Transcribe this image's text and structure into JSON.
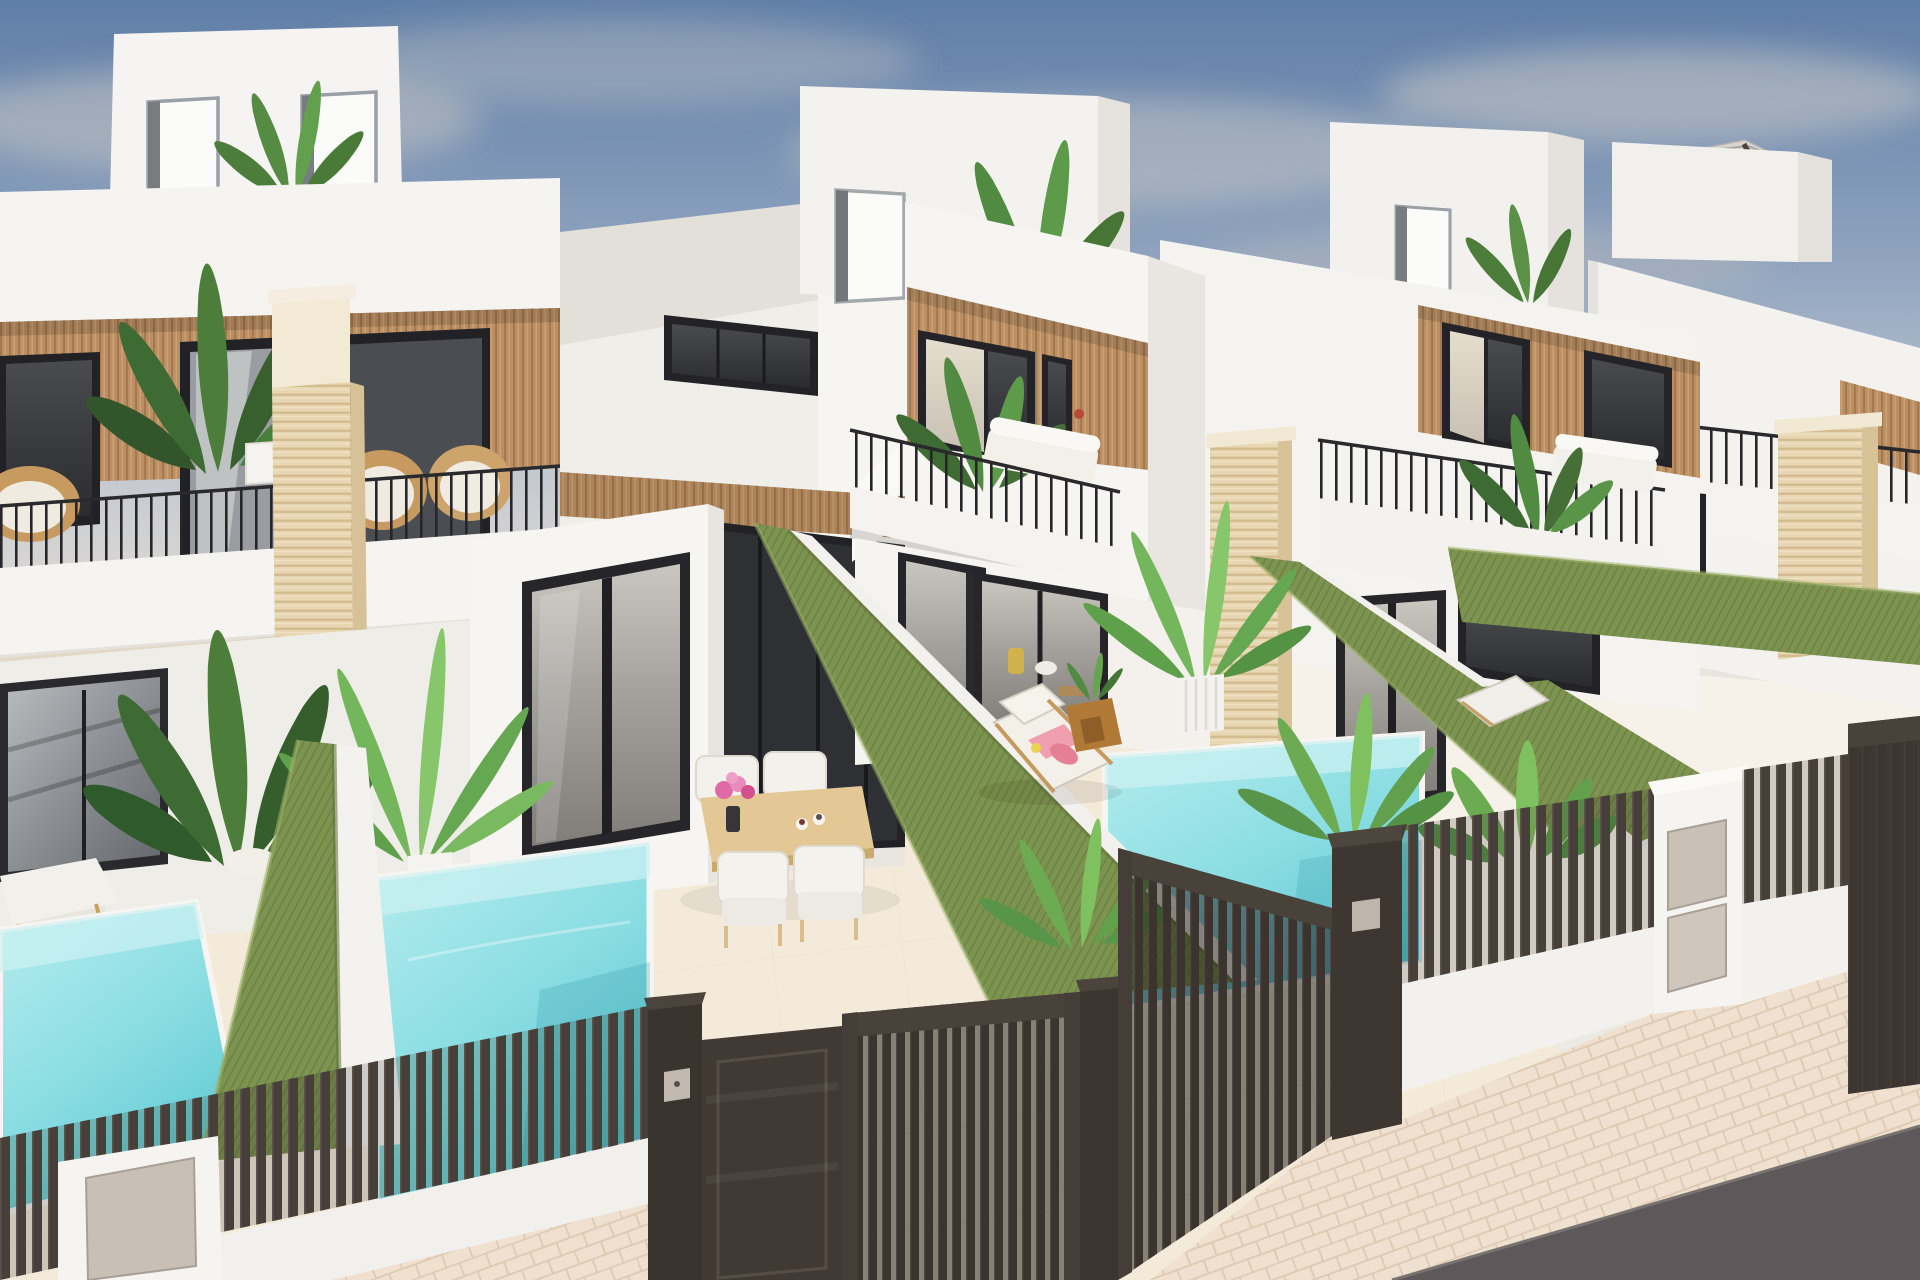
{
  "meta": {
    "scene_type": "exterior-architectural-render",
    "subject": "row of modern white townhouses with private plunge pools, roof terraces and street fence",
    "camera": "elevated three-quarter aerial view",
    "time_of_day": "clear daylight",
    "visible_text": ""
  },
  "palette": {
    "sky_top": "#5f7ea8",
    "sky_mid": "#93a7c2",
    "sky_horizon": "#ece9e3",
    "cloud": "#d8d1c8",
    "wall_white": "#f6f4f1",
    "wall_shadow": "#e7e4df",
    "wall_deep_shadow": "#d9d5d0",
    "wood_slat": "#bb8f63",
    "wood_slat_line": "#a3794d",
    "window_frame": "#232327",
    "glass_dark": "#36383c",
    "glass_reflective": "#9da1a5",
    "curtain": "#ded6c8",
    "railing_metal": "#26262a",
    "travertine": "#e8d7b2",
    "travertine_line": "#d2bc90",
    "grass_wall": "#7d9350",
    "grass_wall_shade": "#5f7338",
    "pool_light": "#b7edef",
    "pool_deep": "#5fc9d3",
    "patio_floor": "#f3ead9",
    "patio_floor_light": "#f7f2e9",
    "fence_dark": "#473f39",
    "gate_dark": "#413a34",
    "pavement": "#efe0cf",
    "pavement_joint": "#ddc9b1",
    "road_asphalt": "#5e585a",
    "rattan": "#c79a5f",
    "cushion_white": "#f2f0ea",
    "towel_pink": "#ef9fb0",
    "towel_pink_deep": "#e57f96",
    "table_wood": "#e3c795",
    "side_table_wood": "#b07a36",
    "plant_dark": "#3e6b33",
    "plant_mid": "#518a41",
    "plant_light": "#6fae54",
    "flower_pink": "#e06aa8",
    "metal_panel": "#c8bfb5",
    "parasol_canopy": "#d8d5d1"
  },
  "scene": {
    "sky": {
      "clouds": 6
    },
    "villas": [
      {
        "id": "villa-1",
        "features": [
          "roof-bulkhead-two-doors",
          "wood-slat-band",
          "two-dark-windows",
          "balcony-two-rattan-chairs",
          "travertine-pillar",
          "ground-glass-door",
          "plunge-pool",
          "dining-set"
        ]
      },
      {
        "id": "villa-2",
        "features": [
          "roof-bulkhead-door",
          "banana-plant",
          "wood-slat-band",
          "curtain-window",
          "balcony-sofa",
          "corner-glass-lounge",
          "sun-lounger",
          "potted-palm",
          "plunge-pool"
        ]
      },
      {
        "id": "villa-3",
        "features": [
          "roof-bulkhead-door",
          "wood-slat-band",
          "balcony-sofa",
          "travertine-pillar",
          "ground-glass-door"
        ]
      },
      {
        "id": "villa-4",
        "features": [
          "roof-parasol",
          "balcony-railing",
          "travertine-pillar",
          "sun-lounger"
        ]
      }
    ],
    "pools": [
      {
        "id": "pool-neighbor",
        "water": "turquoise"
      },
      {
        "id": "pool-villa-1",
        "water": "turquoise"
      },
      {
        "id": "pool-villa-2",
        "water": "turquoise"
      }
    ],
    "dividers": [
      {
        "id": "grass-wall-0"
      },
      {
        "id": "grass-wall-1"
      },
      {
        "id": "grass-wall-2"
      },
      {
        "id": "grass-wall-3"
      },
      {
        "id": "grass-wall-4"
      }
    ],
    "street": {
      "fences": [
        "fence-left",
        "fence-mid-right",
        "fence-right"
      ],
      "gates": [
        "pedestrian-gate",
        "driveway-gate-1",
        "driveway-gate-2",
        "gate-villa-4"
      ],
      "pillars": [
        "mail-pillar-left",
        "keypad-pillar",
        "gate-pillar-1",
        "gate-pillar-2",
        "mail-pillar-right"
      ],
      "sidewalk": "herringbone-pavers",
      "road": "asphalt"
    }
  }
}
